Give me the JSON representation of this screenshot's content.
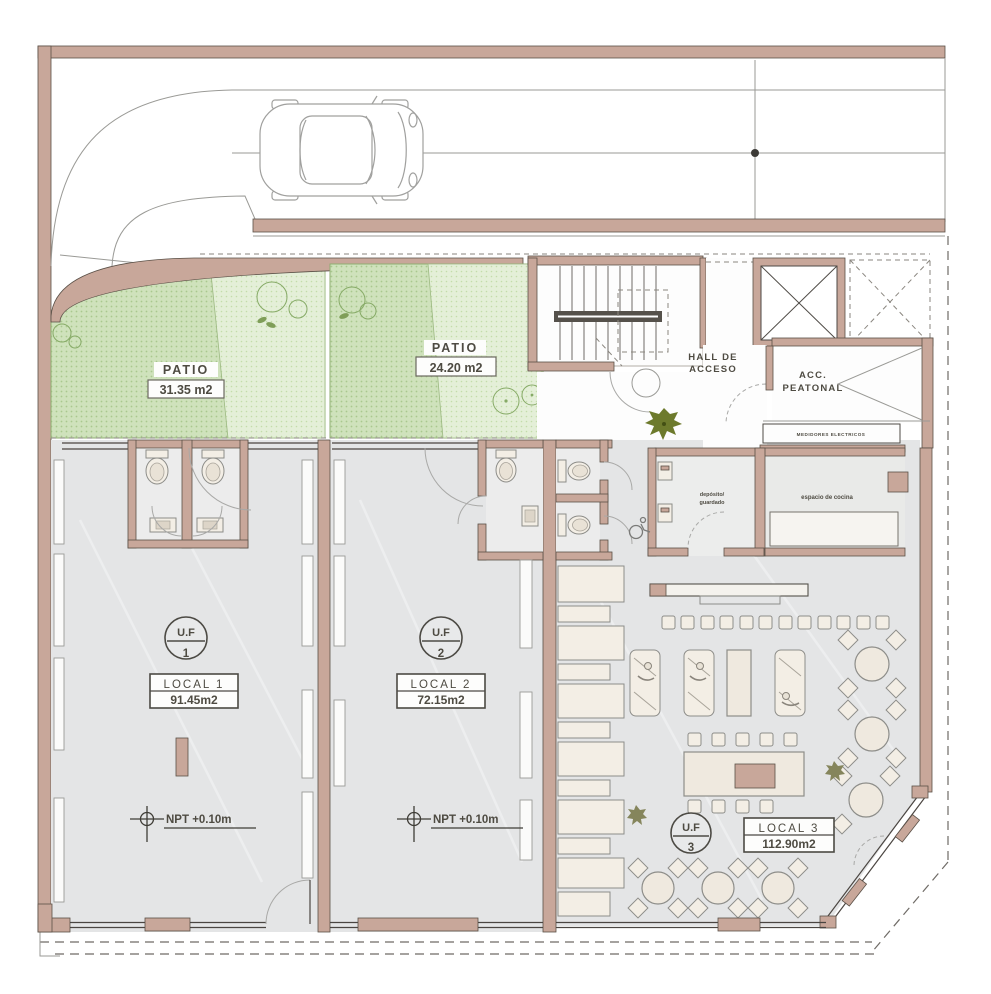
{
  "patios": [
    {
      "label": "PATIO",
      "area": "31.35 m2"
    },
    {
      "label": "PATIO",
      "area": "24.20 m2"
    }
  ],
  "rooms": {
    "hall": {
      "line1": "HALL DE",
      "line2": "ACCESO"
    },
    "acceso_peatonal": {
      "line1": "ACC.",
      "line2": "PEATONAL"
    },
    "medidores": "MEDIDORES ELECTRICOS",
    "deposito": {
      "line1": "depósito/",
      "line2": "guardado"
    },
    "cocina": "espacio de cocina"
  },
  "units": [
    {
      "uf_label": "U.F",
      "uf_number": "1",
      "local_label": "LOCAL 1",
      "local_area": "91.45m2",
      "npt": "NPT +0.10m"
    },
    {
      "uf_label": "U.F",
      "uf_number": "2",
      "local_label": "LOCAL 2",
      "local_area": "72.15m2",
      "npt": "NPT +0.10m"
    },
    {
      "uf_label": "U.F",
      "uf_number": "3",
      "local_label": "LOCAL 3",
      "local_area": "112.90m2"
    }
  ],
  "colors": {
    "wall": "#c8a79a",
    "floor": "#e4e5e6",
    "patio_green": "#cfe2bc",
    "patio_green_light": "#e4efd8",
    "line_dark": "#4a4541",
    "furniture": "#f3eee5",
    "tree_olive": "#6d7a2c",
    "label_text": "#4e4b42"
  },
  "icons": {
    "car": "car-top-view-icon",
    "hall_tree": "tree-icon",
    "wheelchair": "wheelchair-icon",
    "level_marker": "level-marker-icon",
    "stairs": "stairs-icon",
    "elevator": "elevator-icon"
  }
}
